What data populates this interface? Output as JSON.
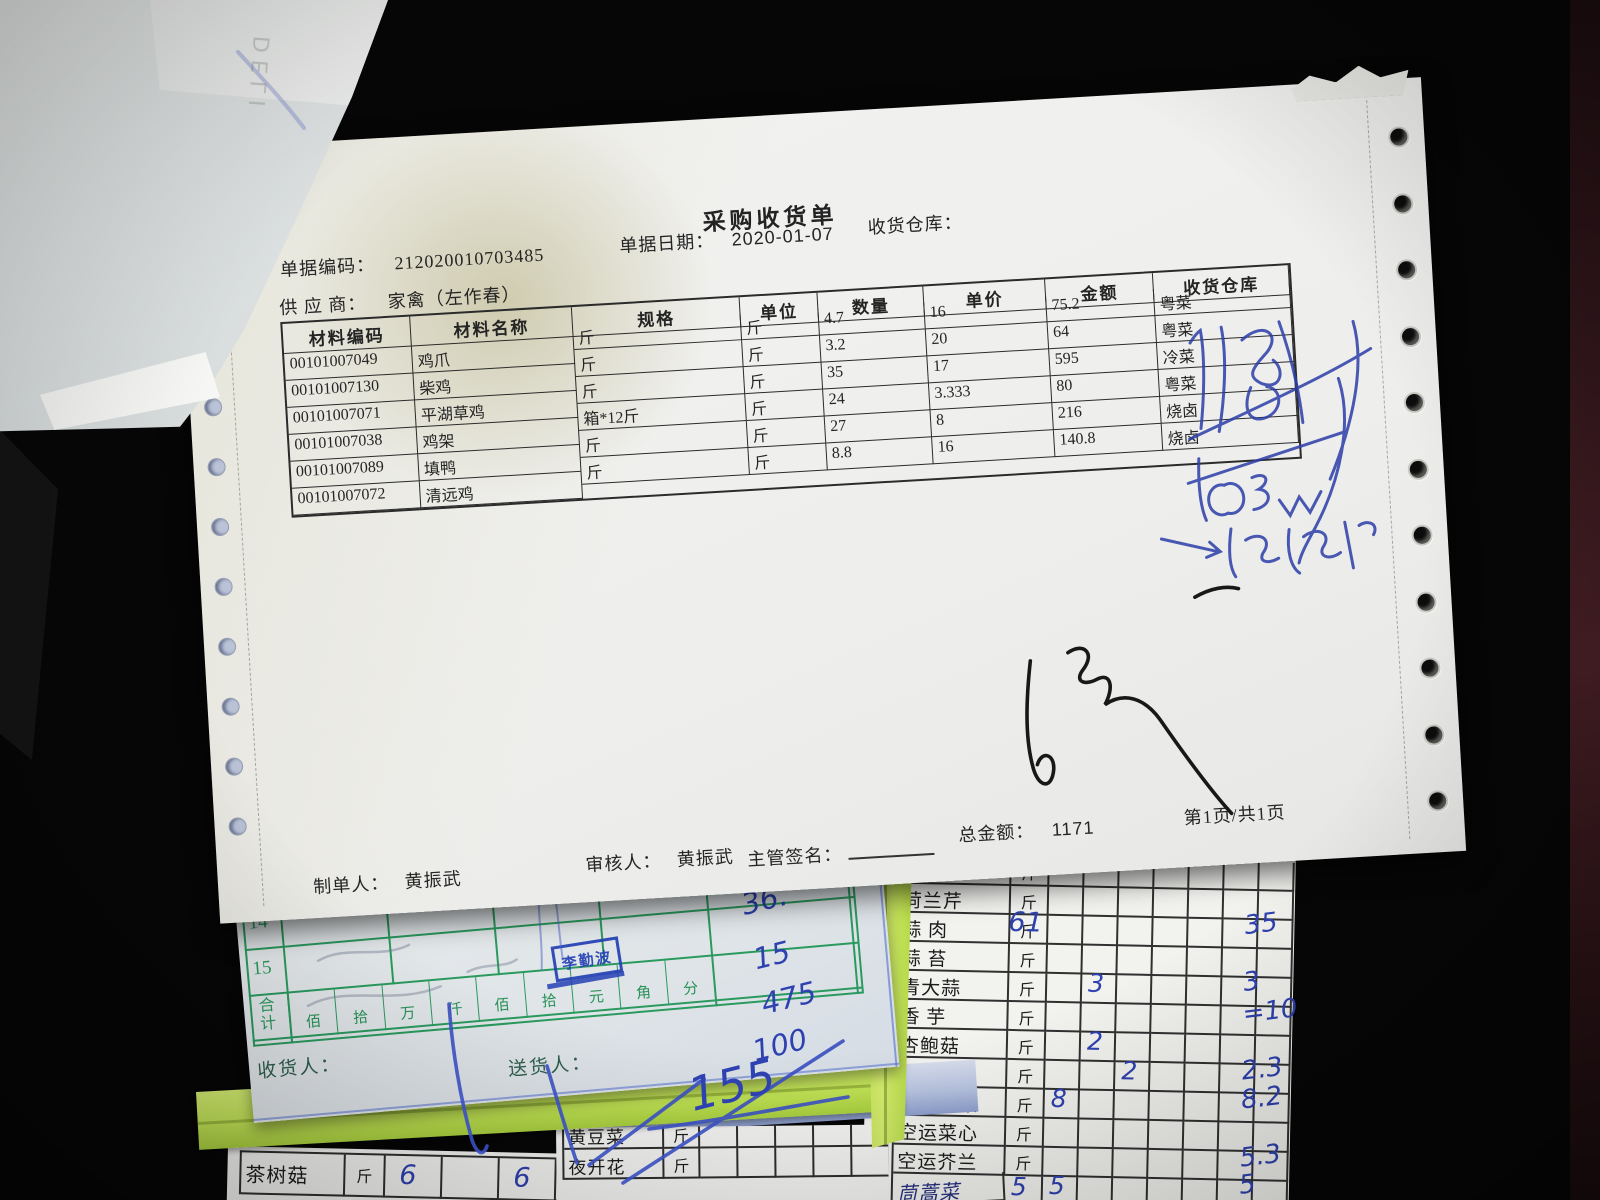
{
  "receipt": {
    "title": "采购收货单",
    "doc_no_label": "单据编码：",
    "doc_no": "212020010703485",
    "date_label": "单据日期：",
    "date": "2020-01-07",
    "warehouse_label": "收货仓库：",
    "supplier_label": "供 应 商：",
    "supplier": "家禽（左作春）",
    "table": {
      "headers": [
        "材料编码",
        "材料名称",
        "规格",
        "单位",
        "数量",
        "单价",
        "金额",
        "收货仓库"
      ],
      "rows": [
        [
          "00101007049",
          "鸡爪",
          "斤",
          "斤",
          "4.7",
          "16",
          "75.2",
          "粤菜"
        ],
        [
          "00101007130",
          "柴鸡",
          "斤",
          "斤",
          "3.2",
          "20",
          "64",
          "粤菜"
        ],
        [
          "00101007071",
          "平湖草鸡",
          "斤",
          "斤",
          "35",
          "17",
          "595",
          "冷菜"
        ],
        [
          "00101007038",
          "鸡架",
          "箱*12斤",
          "斤",
          "24",
          "3.333",
          "80",
          "粤菜"
        ],
        [
          "00101007089",
          "填鸭",
          "斤",
          "斤",
          "27",
          "8",
          "216",
          "烧卤"
        ],
        [
          "00101007072",
          "清远鸡",
          "斤",
          "斤",
          "8.8",
          "16",
          "140.8",
          "烧卤"
        ]
      ]
    },
    "footer": {
      "maker_label": "制单人：",
      "maker": "黄振武",
      "checker_label": "审核人：",
      "checker": "黄振武",
      "sign_label": "主管签名：",
      "total_label": "总金额：",
      "total": "1171",
      "page": "第1页/共1页"
    }
  },
  "green_form": {
    "row_nums": [
      "14",
      "15"
    ],
    "sum_label": "合计",
    "unit_chars": [
      "佰",
      "拾",
      "万",
      "仟",
      "佰",
      "拾",
      "元",
      "角",
      "分"
    ],
    "stamp": "李勤波",
    "receiver_label": "收货人：",
    "deliverer_label": "送货人：",
    "amounts": [
      "36.",
      "15",
      "475",
      "100"
    ],
    "amount_note": "155"
  },
  "veg_sheet": {
    "rows": [
      {
        "name": "西  芹",
        "unit": "斤"
      },
      {
        "name": "荷兰芹",
        "unit": "斤"
      },
      {
        "name": "蒜  肉",
        "unit": "斤",
        "hand": "61",
        "amount": "35"
      },
      {
        "name": "蒜  苔",
        "unit": "斤"
      },
      {
        "name": "青大蒜",
        "unit": "斤",
        "qty": "3",
        "qcol": 1,
        "amount": "3"
      },
      {
        "name": "香  芋",
        "unit": "斤",
        "margin": "2",
        "amount": "=10"
      },
      {
        "name": "杏鲍菇",
        "unit": "斤",
        "qty": "2",
        "qcol": 1,
        "margin": "9"
      },
      {
        "name": "红彩椒",
        "unit": "斤",
        "qty": "2",
        "qcol": 2,
        "margin": "1",
        "amount": "2.3"
      },
      {
        "name": "水东芥菜",
        "unit": "斤",
        "qty": "8",
        "qcol": 0,
        "amount": "8.2"
      },
      {
        "name": "空运菜心",
        "unit": "斤"
      },
      {
        "name": "空运芥兰",
        "unit": "斤",
        "amount": "5.3"
      },
      {
        "name": "茼蒿菜",
        "hw": true,
        "qty_unit": "5",
        "qty": "5",
        "qcol": 0,
        "amount": "5"
      }
    ]
  },
  "left_sheet": {
    "rows": [
      {
        "name": "茶树菇",
        "unit": "斤",
        "cells": [
          "6",
          "",
          "6",
          "",
          "",
          ""
        ]
      }
    ]
  },
  "mid_sheet": {
    "rows": [
      {
        "name": "黄豆菜",
        "unit": "斤"
      },
      {
        "name": "夜开花",
        "unit": "斤"
      }
    ]
  },
  "bleedthrough": {
    "letters": "DELI"
  }
}
